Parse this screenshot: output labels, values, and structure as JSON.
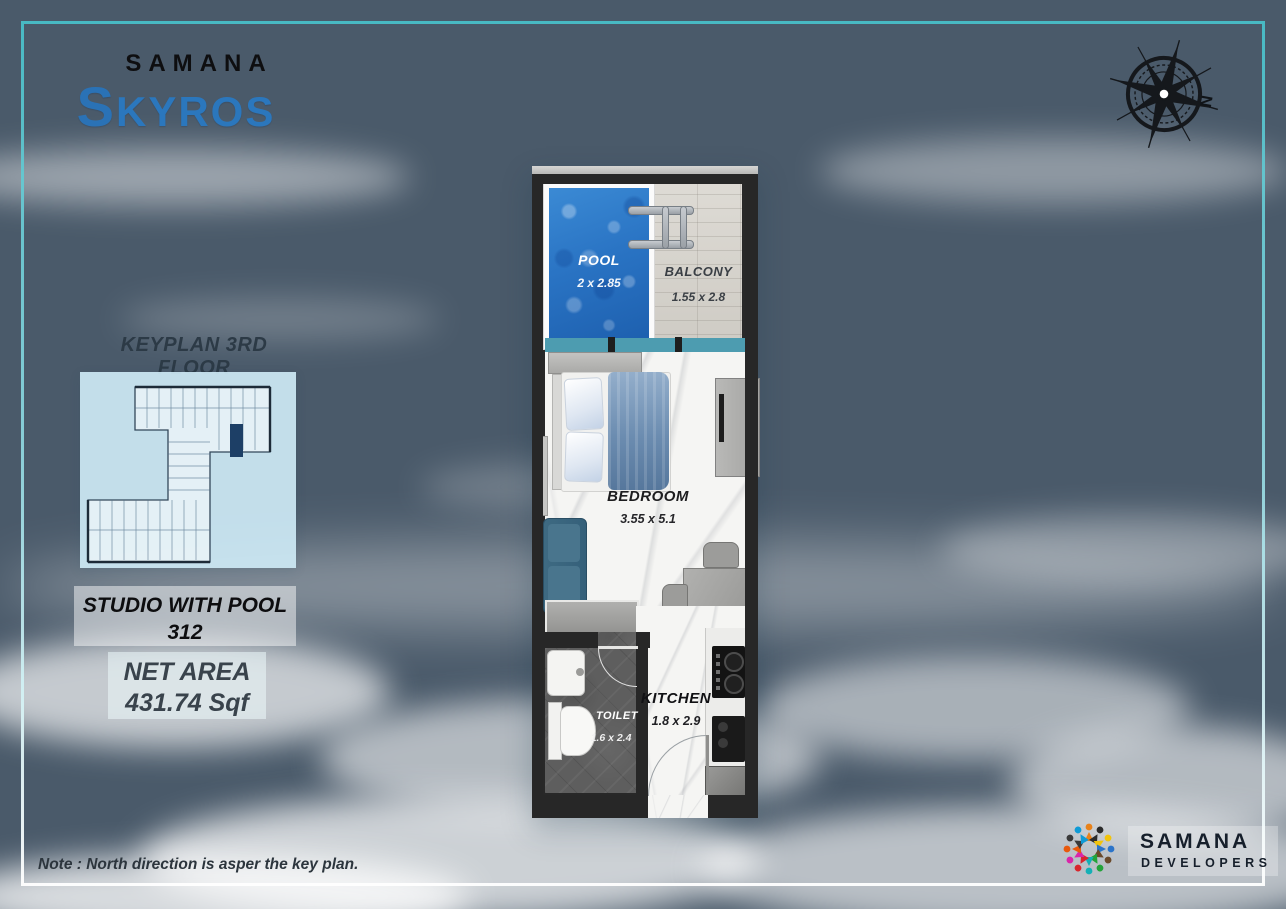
{
  "brand": {
    "name": "SAMANA",
    "product": "SKYROS"
  },
  "compass": {
    "north_label": "N"
  },
  "keyplan": {
    "title": "KEYPLAN 3RD FLOOR"
  },
  "unit_card": {
    "type": "STUDIO WITH POOL",
    "number": "312"
  },
  "area_card": {
    "label": "NET AREA",
    "value": "431.74 Sqf"
  },
  "floorplan": {
    "pool": {
      "label": "POOL",
      "dims": "2 x 2.85"
    },
    "balcony": {
      "label": "BALCONY",
      "dims": "1.55 x 2.8"
    },
    "bedroom": {
      "label": "BEDROOM",
      "dims": "3.55 x 5.1"
    },
    "kitchen": {
      "label": "KITCHEN",
      "dims": "1.8 x 2.9"
    },
    "toilet": {
      "label": "TOILET",
      "dims": "1.6 x 2.4"
    }
  },
  "note": "Note : North direction is asper the key plan.",
  "developer": {
    "name": "SAMANA",
    "tagline": "DEVELOPERS"
  },
  "colors": {
    "frame_teal": "#48bec8",
    "brand_blue": "#2b77bd",
    "pool_water": "#2a74c4",
    "window_teal": "#4d9cb0",
    "keyplan_highlight": "#1d3f66",
    "wall_dark": "#272727"
  }
}
